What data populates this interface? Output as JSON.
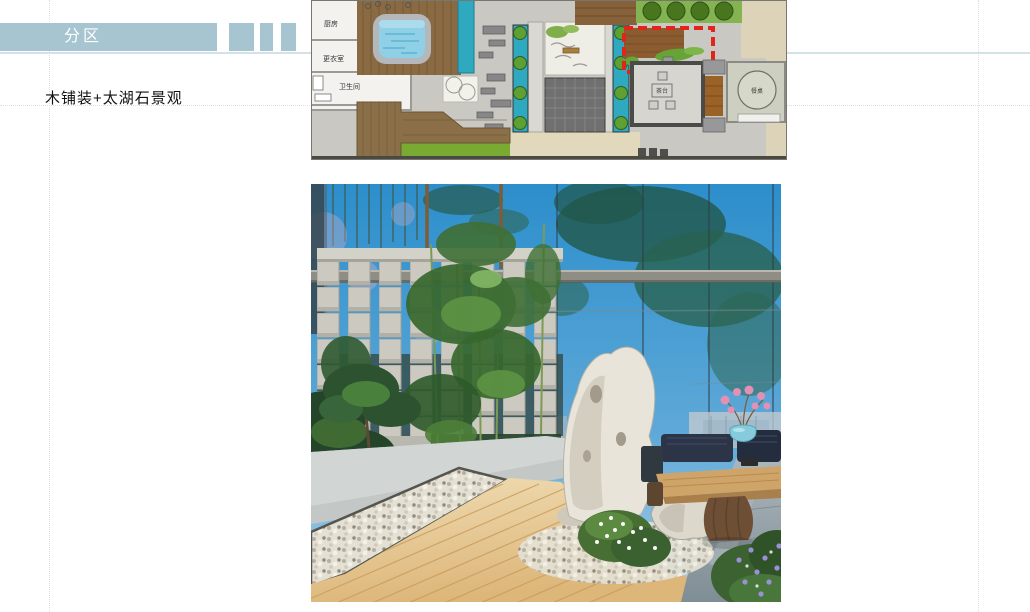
{
  "slide": {
    "section_banner": "分区",
    "caption": "木铺装+太湖石景观"
  },
  "floor_plan": {
    "room_labels": {
      "kitchen": "厨房",
      "dressing_room": "更衣室",
      "bathroom": "卫生间",
      "tea_table": "茶台",
      "dining_table": "餐桌"
    },
    "highlight_color": "#e0261a"
  },
  "colors": {
    "banner_blue": "#a7c5d1",
    "accent_line": "#d3e2e9",
    "highlight_red": "#e0261a"
  }
}
